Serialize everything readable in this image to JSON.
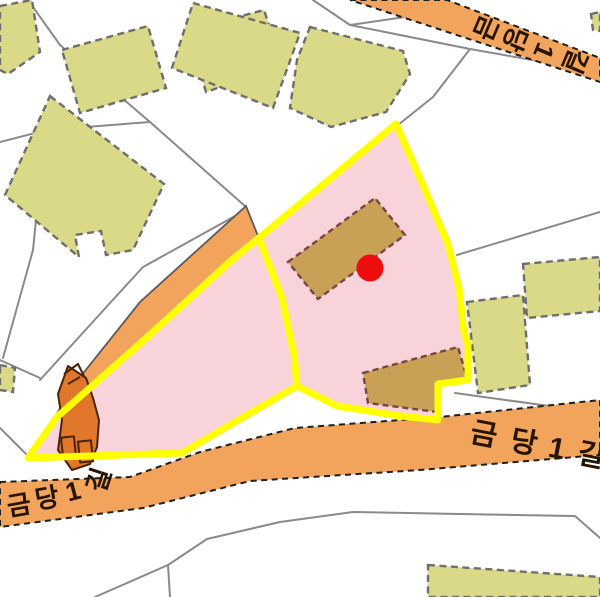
{
  "map": {
    "colors": {
      "background": "#ffffff",
      "parcel_line": "#8a8a8a",
      "building_fill": "#d9d987",
      "road_fill": "#f3a45c",
      "annex_fill": "#c9a156",
      "structure_small_fill": "#e0772b",
      "parcel_fill": "#f9d3da",
      "highlight": "#ffff00",
      "marker": "#ee0d0d",
      "label_text": "#241400"
    },
    "roads": {
      "top_right": {
        "name": "금당1길",
        "chars": [
          "금",
          "당",
          "1",
          "길"
        ]
      },
      "bottom_left": {
        "name": "금당1길",
        "chars": [
          "금",
          "당",
          "1",
          "길"
        ]
      },
      "bottom_right": {
        "name": "금당1길",
        "chars": [
          "금",
          "당",
          "1",
          "길"
        ]
      }
    },
    "marker": {
      "shape": "red-dot"
    }
  }
}
